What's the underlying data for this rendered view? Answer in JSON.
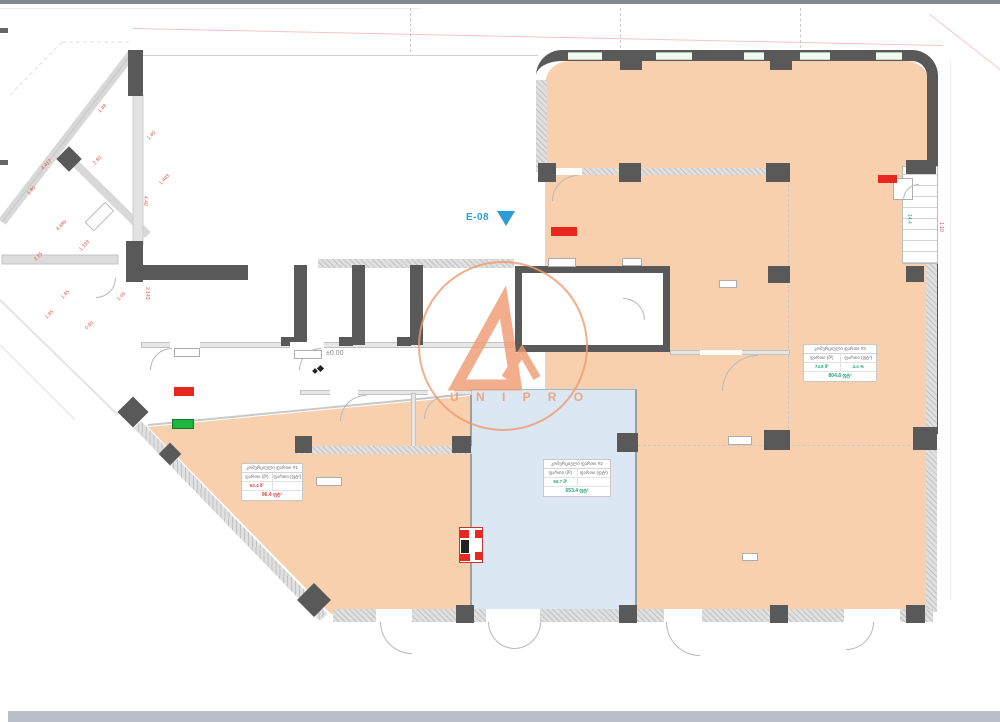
{
  "labels": {
    "level_marker": "±0.00",
    "elevation_tag": "E-08"
  },
  "logo": {
    "text": "U N I P R O"
  },
  "colors": {
    "room_orange": "#f8d0ae",
    "room_blue": "#dbe8f4",
    "wall_dark": "#595959",
    "wall_light": "#e0e0e0",
    "accent_red": "#e8281e",
    "accent_green": "#1fb53f",
    "elevation_blue": "#2b9cd8",
    "logo_orange": "#ef9a6f",
    "dimension_red": "#e05252",
    "table_green": "#23a57c",
    "table_red": "#e04343"
  },
  "tables": [
    {
      "title": "კომერციული ფართი #1",
      "c1": "ფართი (მ²)",
      "c2": "ფართი (ფტ²)",
      "v1": "62.4 მ²",
      "v2": "",
      "total": "96.4 ფტ²",
      "value_color": "#e04343"
    },
    {
      "title": "კომერციული ფართი #2",
      "c1": "ფართი (მ²)",
      "c2": "ფართი (ფტ²)",
      "v1": "60.7 მ²",
      "v2": "",
      "total": "653.4 ფტ²",
      "value_color": "#23a57c"
    },
    {
      "title": "კომერციული ფართი #3",
      "c1": "ფართი (მ²)",
      "c2": "ფართი (ფტ²)",
      "v1": "74.8 მ²",
      "v2": "4.4 %",
      "total": "804.8 ფტ²",
      "value_color": "#23a57c"
    }
  ],
  "annotations": [
    {
      "text": "4.417",
      "x": 40,
      "y": 167,
      "rot": -45
    },
    {
      "text": "1.80",
      "x": 26,
      "y": 192,
      "rot": -45
    },
    {
      "text": "4.489",
      "x": 55,
      "y": 228,
      "rot": -45
    },
    {
      "text": "1.103",
      "x": 78,
      "y": 248,
      "rot": -45
    },
    {
      "text": "2.80",
      "x": 92,
      "y": 162,
      "rot": -45
    },
    {
      "text": "1.40",
      "x": 146,
      "y": 137,
      "rot": -45
    },
    {
      "text": "1.443",
      "x": 158,
      "y": 182,
      "rot": -45
    },
    {
      "text": "4.40",
      "x": 148,
      "y": 196,
      "rot": 90
    },
    {
      "text": "2.143",
      "x": 150,
      "y": 287,
      "rot": 90
    },
    {
      "text": "1.05",
      "x": 116,
      "y": 298,
      "rot": -45
    },
    {
      "text": "0.90",
      "x": 84,
      "y": 327,
      "rot": -45
    },
    {
      "text": "1.95",
      "x": 44,
      "y": 316,
      "rot": -45
    },
    {
      "text": "1.85",
      "x": 60,
      "y": 296,
      "rot": -45
    },
    {
      "text": "2.25",
      "x": 33,
      "y": 258,
      "rot": -45
    },
    {
      "text": "1.48",
      "x": 97,
      "y": 110,
      "rot": -45
    },
    {
      "text": "14.4",
      "x": 912,
      "y": 214,
      "rot": 90,
      "color": "#2aa87a"
    },
    {
      "text": "1.10",
      "x": 944,
      "y": 222,
      "rot": 90
    }
  ]
}
